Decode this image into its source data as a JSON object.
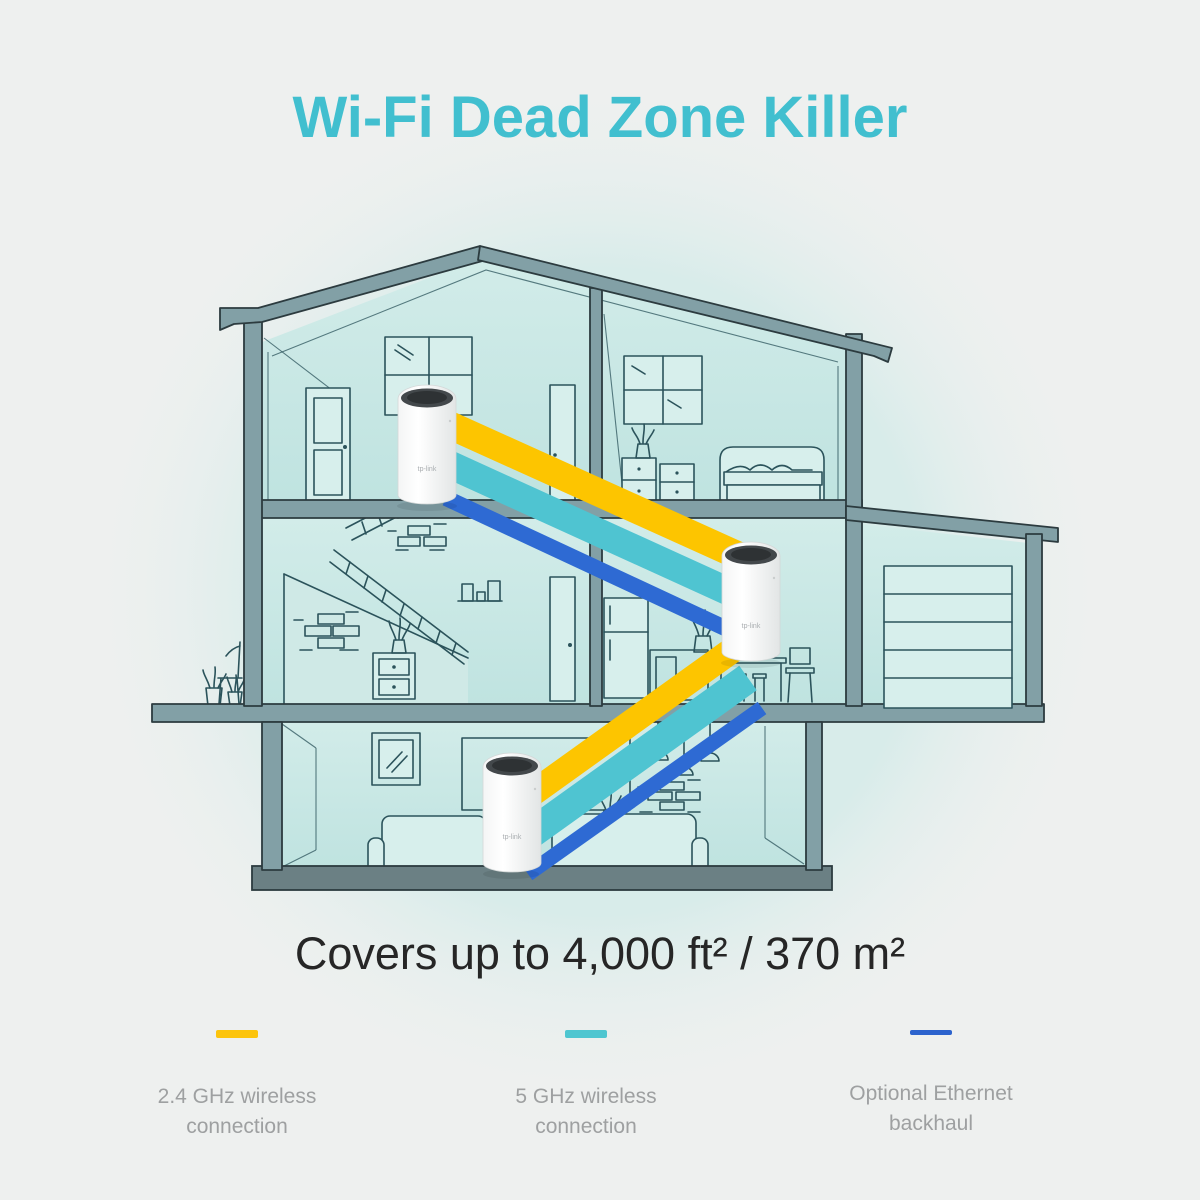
{
  "title": "Wi-Fi Dead Zone Killer",
  "coverage_text": "Covers up to 4,000 ft² / 370 m²",
  "legend": [
    {
      "label": [
        "2.4 GHz wireless",
        "connection"
      ],
      "color": "#fcc40c",
      "height": 8
    },
    {
      "label": [
        "5 GHz wireless",
        "connection"
      ],
      "color": "#4ec6d0",
      "height": 8
    },
    {
      "label": [
        "Optional Ethernet",
        "backhaul"
      ],
      "color": "#2c63cd",
      "height": 5
    }
  ],
  "devices": {
    "count": 3,
    "logo_text": "tp-link"
  },
  "colors": {
    "title_color": "#41bfcf",
    "coverage_color": "#262626",
    "label_color": "#9ea0a1",
    "band_24": "#fdc500",
    "band_5": "#4fc4d1",
    "band_eth": "#2e6ad3",
    "page_bg": "#eef0ef",
    "beam": "#82a0a6",
    "beam_dark": "#6b8084",
    "ink": "#2b535b",
    "panel": "#d7efec"
  }
}
